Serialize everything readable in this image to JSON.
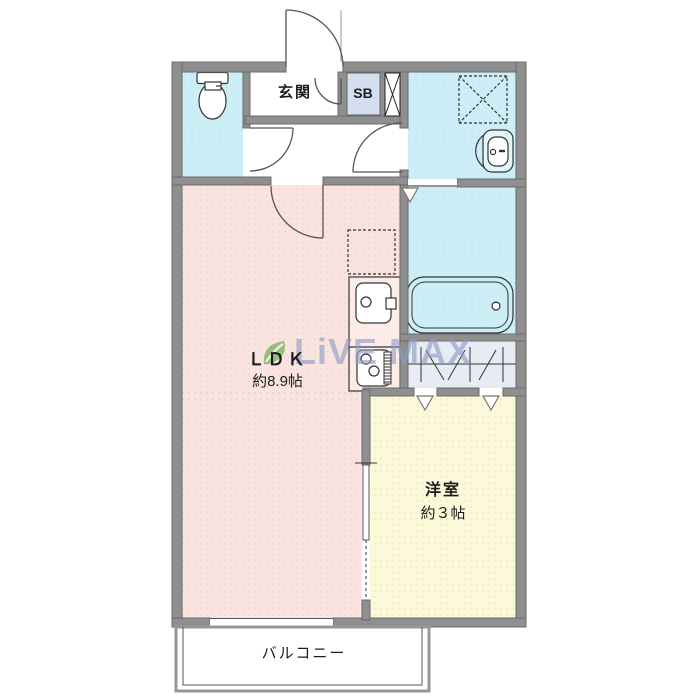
{
  "image_type": "apartment_floor_plan",
  "watermark": {
    "text": "LiVE MAX"
  },
  "rooms": {
    "genkan": {
      "label": "玄関"
    },
    "shoebox": {
      "label": "SB"
    },
    "ldk": {
      "label": "ＬＤＫ",
      "size": "約8.9帖"
    },
    "western": {
      "label": "洋室",
      "size": "約３帖"
    },
    "balcony": {
      "label": "バルコニー"
    }
  },
  "icons": [
    "toilet-icon",
    "bathtub-icon",
    "washbasin-icon",
    "kitchen-sink-icon",
    "stove-icon",
    "washing-machine-space-icon",
    "refrigerator-space-icon",
    "closet-hanger-icon",
    "pipe-space-icon",
    "door-swing-icon",
    "opening-triangle-icon",
    "livemax-leaf-icon"
  ],
  "colors": {
    "wall": "#8f8f8f",
    "ldk_floor": "#f9e4e0",
    "wet_area_floor": "#cdeef6",
    "western_floor": "#fbf9da",
    "shoebox_fill": "#d3dfef",
    "closet_fill": "#e7ebf4",
    "watermark_text": "#8e9cc6",
    "logo_green": "#5fa83e",
    "line": "#444444"
  }
}
